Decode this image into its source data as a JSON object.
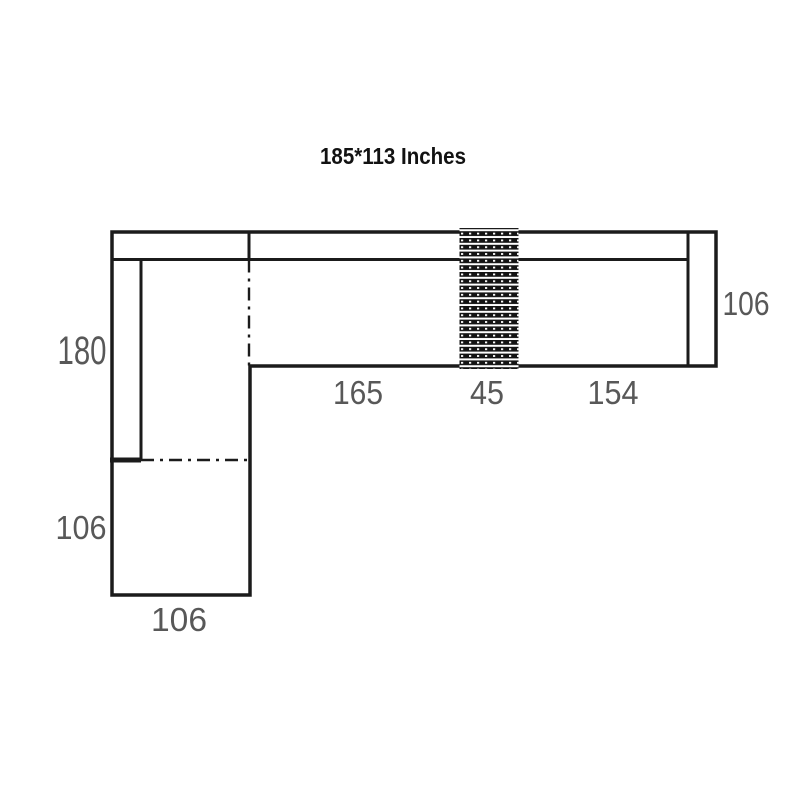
{
  "title": "185*113 Inches",
  "colors": {
    "background": "#ffffff",
    "line": "#1b1b1b",
    "dimension_text": "#585858",
    "title_text": "#121212"
  },
  "diagram_type": "sectional-sofa-floor-plan",
  "dimensions": {
    "left_length": "180",
    "left_lower_depth": "106",
    "bottom_width": "106",
    "seat_left": "165",
    "console": "45",
    "seat_right": "154",
    "right_depth": "106"
  }
}
